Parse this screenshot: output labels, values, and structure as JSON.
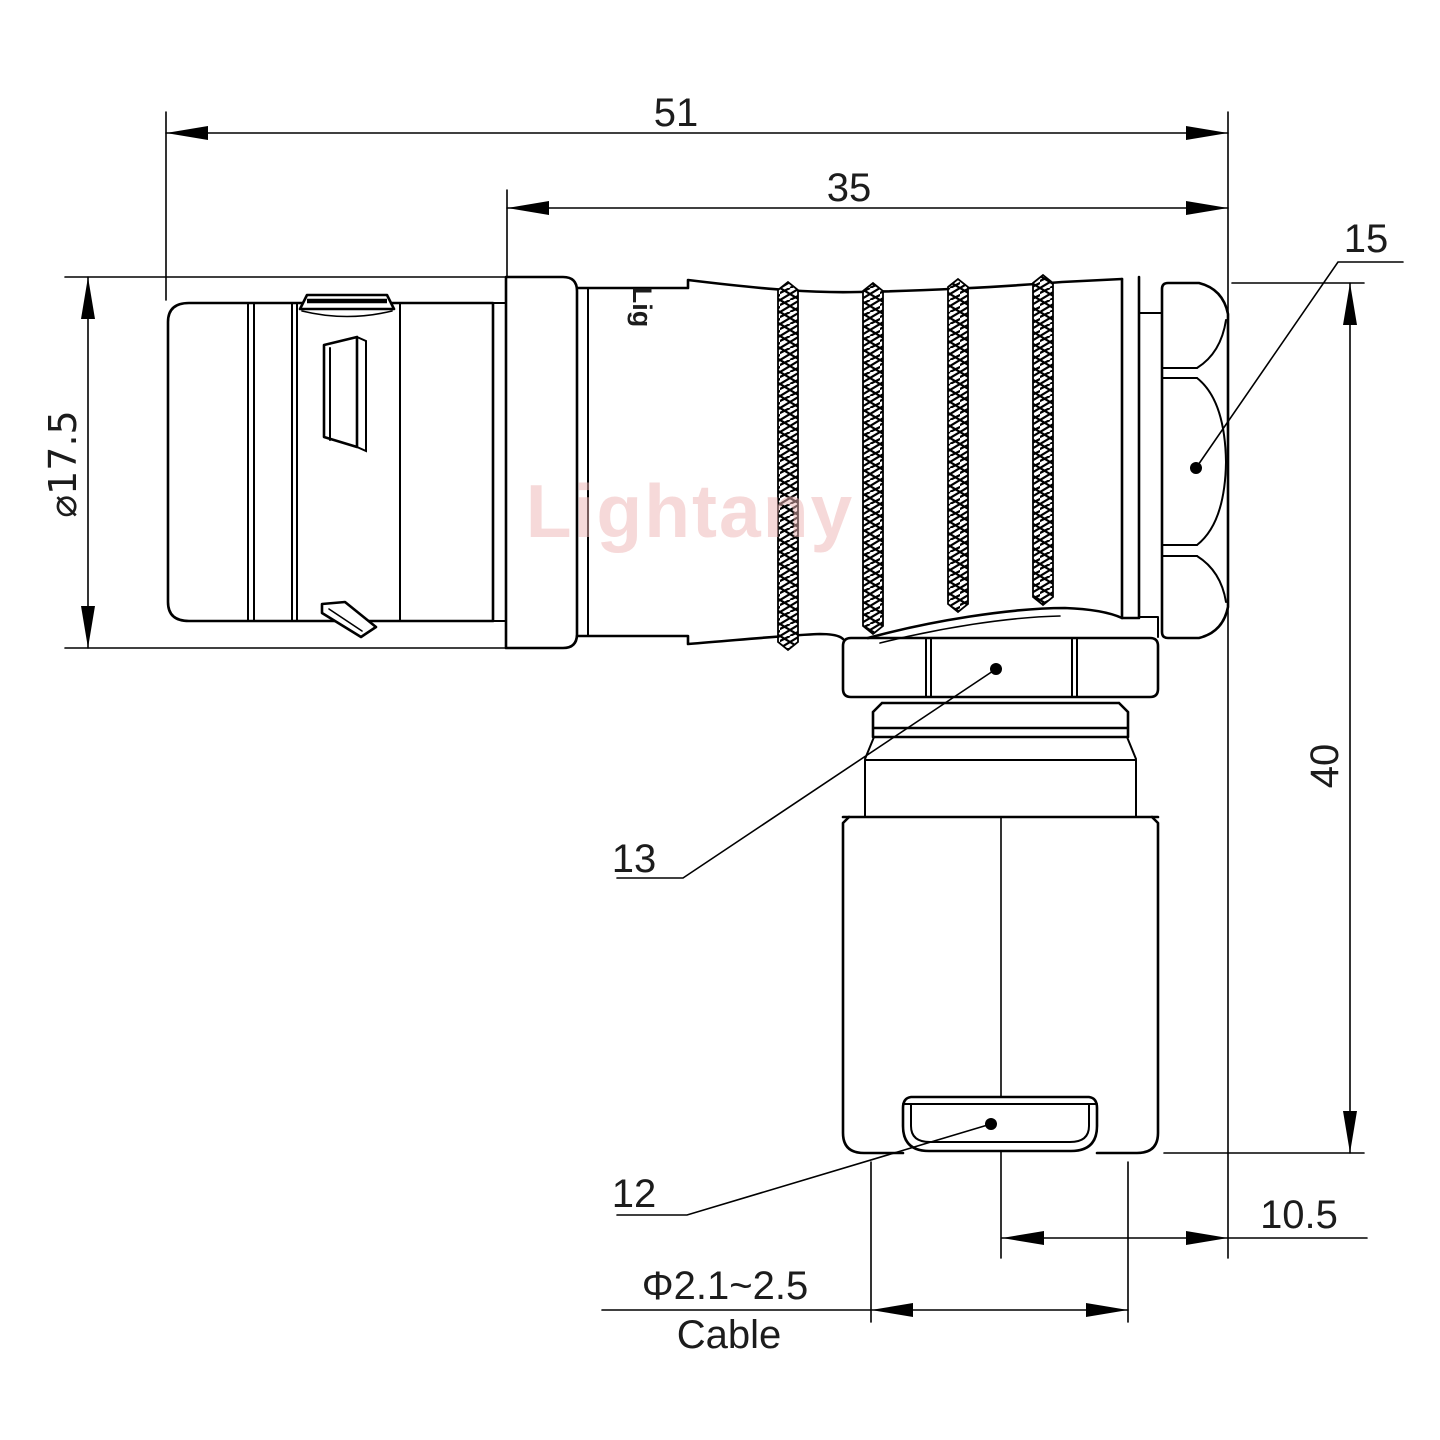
{
  "drawing": {
    "title": "right-angle connector technical drawing",
    "watermark": "Lightany",
    "engraving": "Lig",
    "line_color": "#000000",
    "watermark_color": "#eeb5b5",
    "dimensions": {
      "overall_length": "51",
      "body_length": "35",
      "nut_size": "15",
      "front_diameter": "⌀17.5",
      "total_height": "40",
      "coupling_nut_ref": "13",
      "cable_clamp_ref": "12",
      "side_offset": "10.5",
      "cable_range": "Φ2.1~2.5",
      "cable_word": "Cable"
    }
  }
}
